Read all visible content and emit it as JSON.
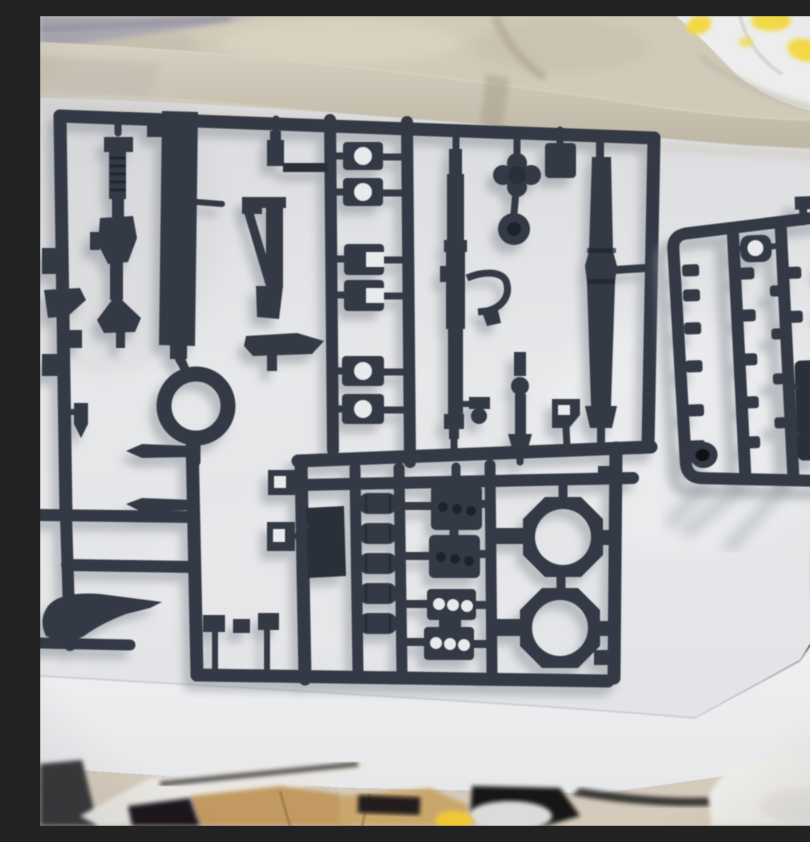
{
  "scene": {
    "description": "Top-down photograph of two dark gunmetal-gray plastic model kit runners (sprues) holding unassembled weapon and accessory parts, lying inside an open white cardboard box. Blurred gray fabric, a beige blanket and a white sheet printed with yellow flowers appear behind the box at the top; the box front edge and cluttered floor (dark object, tan wooden pieces, a white rounded object, a small yellow object and white fluffy fabric) are visible at the bottom.",
    "camera": "slightly tilted handheld top-down shot, shallow focus, soft shadows cast down-left",
    "text_visible": "none"
  },
  "objects": {
    "main_sprue_parts": [
      "assault rifle",
      "bullpup rifle with bipod stock",
      "long blade slab",
      "long sniper rifle with trigger guard",
      "bazooka tube",
      "cross-shaped knob",
      "round knob",
      "six barrel clamp clips",
      "large ring",
      "two pointed lances",
      "bullet-shaped part",
      "curved sword",
      "five cylinder capsules",
      "two ammo magazines with three dots",
      "two vented plates with three holes",
      "two octagonal scope rings",
      "flat panel",
      "assorted small brackets"
    ],
    "small_sprue_parts": [
      "rows of small peg parts",
      "ring clip with hole",
      "flat panel",
      "socket part with dark bore",
      "top nub"
    ],
    "box": "open white box, beige far rim band, right corner fold, bright front edge",
    "floor_items": [
      "dark gray object with white stripe",
      "tan wooden pieces",
      "black shadow patches",
      "white rounded object",
      "small yellow object",
      "white fluffy fabric"
    ]
  },
  "counts": {
    "sprues": 2,
    "scope_rings": 2,
    "magazines": 2,
    "cylinders": 5,
    "barrel_clamps": 6
  },
  "colors": {
    "sprue": "#333a45",
    "sprue-dark": "#2a3039",
    "sprue-deep": "#1e232b",
    "hole-white": "#e9eaec",
    "box-interior": "#e4e5e8",
    "box-front": "#f0f1f3",
    "rim-beige": "#cdc6b4",
    "rim-dark": "#b5ae9c",
    "fabric-gray": "#a9a6b1",
    "blanket-beige": "#d1cab8",
    "sheet-white": "#ecedec",
    "flower-yellow": "#f3d943",
    "leaf-green": "#c7d8ad",
    "floor-beige": "#d5cbbc",
    "floor-tan": "#c39a5e",
    "floor-dark": "#39373b",
    "floor-black": "#1c191b",
    "fluff-white": "#eeece8",
    "object-yellow": "#f3c733",
    "shadow-gray": "#878d95"
  }
}
